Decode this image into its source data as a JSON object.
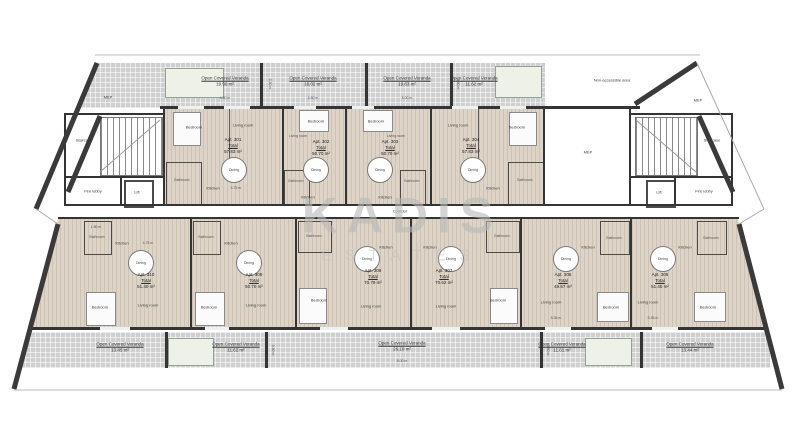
{
  "watermark": {
    "line1": "KADIS",
    "line2": "ESTATES"
  },
  "labels": {
    "corridor": "Corridor",
    "staircase": "Staircase",
    "fire_lobby": "Fire lobby",
    "lift": "Lift",
    "mep": "MEP",
    "non_accessible": "Non-accessible area",
    "total": "Total"
  },
  "rooms": {
    "bedroom": "Bedroom",
    "living": "Living room",
    "dining": "Dining",
    "kitchen": "Kitchen",
    "bathroom": "Bathroom"
  },
  "dims": {
    "d450": "4.50 m",
    "d800": "8.00 m",
    "d380": "3.80 m",
    "d475": "4.75 m",
    "d180": "1.80 m",
    "d535": "5.35 m"
  },
  "apartments_top": [
    {
      "number": "Apt. 301",
      "area": "57.83 m²"
    },
    {
      "number": "Apt. 302",
      "area": "50.70 m²"
    },
    {
      "number": "Apt. 303",
      "area": "50.70 m²"
    },
    {
      "number": "Apt. 304",
      "area": "57.83 m²"
    }
  ],
  "apartments_bottom": [
    {
      "number": "Apt. 310",
      "area": "51.40 m²"
    },
    {
      "number": "Apt. 309",
      "area": "50.70 m²"
    },
    {
      "number": "Apt. 308",
      "area": "70.79 m²"
    },
    {
      "number": "Apt. 307",
      "area": "70.62 m²"
    },
    {
      "number": "Apt. 306",
      "area": "49.57 m²"
    },
    {
      "number": "Apt. 305",
      "area": "51.40 m²"
    }
  ],
  "top_verandas": [
    {
      "name": "Open Covered Veranda",
      "area": "19.90 m²",
      "dim": "4.50 m"
    },
    {
      "name": "Open Covered Veranda",
      "area": "16.02 m²",
      "dim": "4.50 m"
    },
    {
      "name": "Open Covered Veranda",
      "area": "19.63 m²",
      "dim": "8.00 m"
    },
    {
      "name": "Open Covered Veranda",
      "area": "11.62 m²",
      "dim": "4.50 m"
    }
  ],
  "bottom_verandas": [
    {
      "name": "Open Covered Veranda",
      "area": "13.45 m²"
    },
    {
      "name": "Open Covered Veranda",
      "area": "11.62 m²"
    },
    {
      "name": "Open Covered Veranda",
      "area": "26.10 m²"
    },
    {
      "name": "Open Covered Veranda",
      "area": "11.61 m²"
    },
    {
      "name": "Open Covered Veranda",
      "area": "13.44 m²"
    }
  ]
}
